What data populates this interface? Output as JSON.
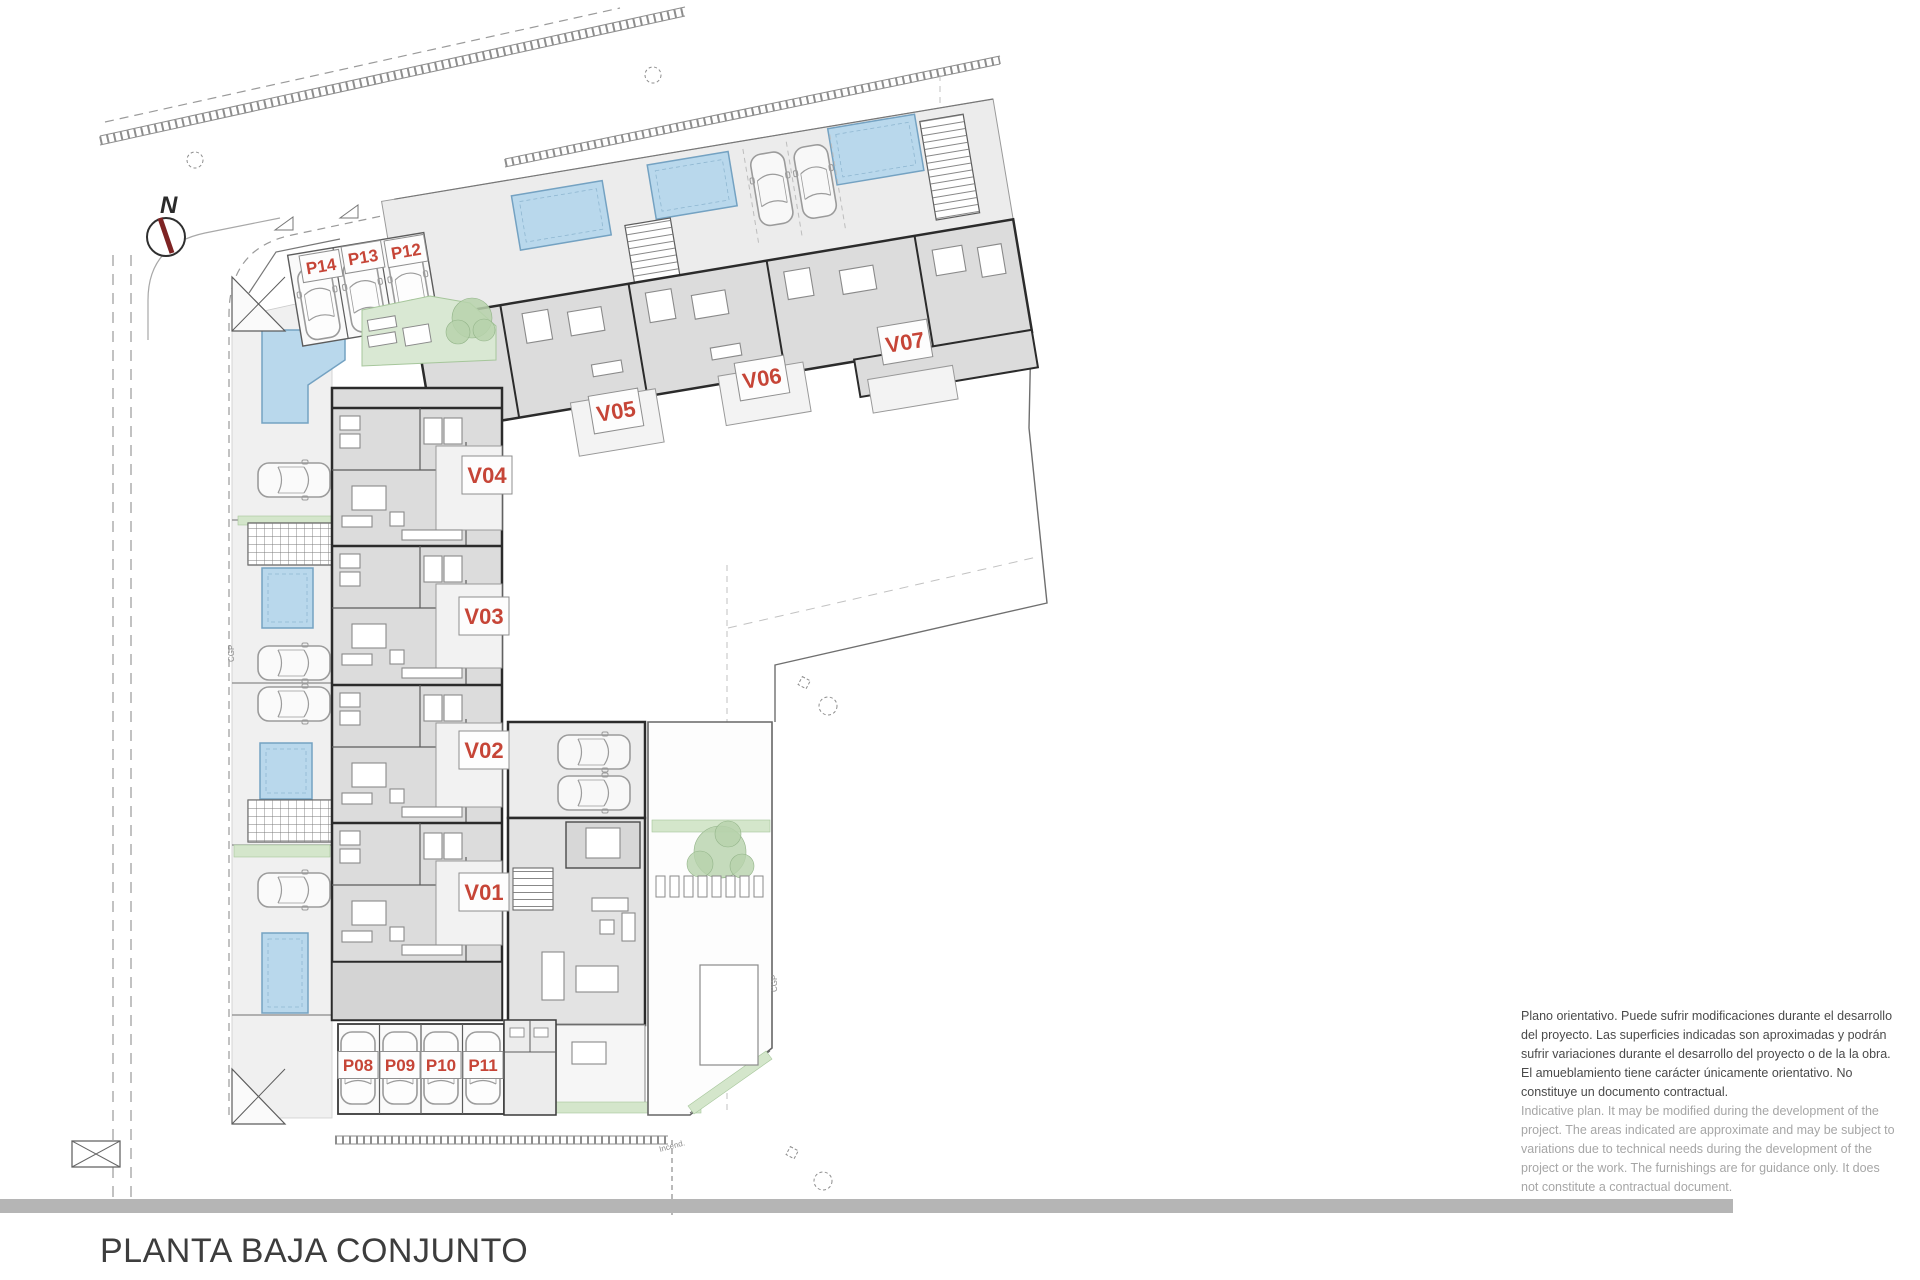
{
  "title": "PLANTA BAJA CONJUNTO",
  "compass_label": "N",
  "unit_labels": [
    {
      "id": "V01",
      "x": 484,
      "y": 892,
      "rot": 0
    },
    {
      "id": "V02",
      "x": 484,
      "y": 750,
      "rot": 0
    },
    {
      "id": "V03",
      "x": 484,
      "y": 616,
      "rot": 0
    },
    {
      "id": "V04",
      "x": 487,
      "y": 475,
      "rot": 0
    },
    {
      "id": "V05",
      "x": 616,
      "y": 411,
      "rot": -9.5
    },
    {
      "id": "V06",
      "x": 762,
      "y": 378,
      "rot": -9.5
    },
    {
      "id": "V07",
      "x": 905,
      "y": 342,
      "rot": -9.5
    }
  ],
  "parking_labels": [
    {
      "id": "P08",
      "x": 358,
      "y": 1065,
      "rot": 0
    },
    {
      "id": "P09",
      "x": 400,
      "y": 1065,
      "rot": 0
    },
    {
      "id": "P10",
      "x": 441,
      "y": 1065,
      "rot": 0
    },
    {
      "id": "P11",
      "x": 483,
      "y": 1065,
      "rot": 0
    },
    {
      "id": "P12",
      "x": 406,
      "y": 251,
      "rot": -9.5
    },
    {
      "id": "P13",
      "x": 363,
      "y": 257,
      "rot": -9.5
    },
    {
      "id": "P14",
      "x": 321,
      "y": 266,
      "rot": -9.5
    }
  ],
  "utility_labels": [
    {
      "text": "CGP",
      "x": 234,
      "y": 662,
      "rot": -90
    },
    {
      "text": "CGP",
      "x": 777,
      "y": 992,
      "rot": -90
    },
    {
      "text": "Incend.",
      "x": 660,
      "y": 1152,
      "rot": -15
    }
  ],
  "disclaimer": {
    "es_lines": [
      "Plano orientativo. Puede sufrir modificaciones durante el desarrollo",
      "del proyecto. Las superficies indicadas son aproximadas y podrán",
      "sufrir variaciones durante el desarrollo del proyecto o de la la obra.",
      "El amueblamiento tiene carácter únicamente orientativo. No",
      "constituye un documento contractual."
    ],
    "en_lines": [
      "Indicative plan. It may be modified during the development of the",
      "project. The areas indicated are approximate and may be subject to",
      "variations due to technical needs during the development of the",
      "project or the work. The furnishings are for guidance only. It does",
      "not constitute a contractual document."
    ]
  },
  "colors": {
    "label_red": "#c64537",
    "pool_fill": "#b9d8ec",
    "pool_edge": "#74a2c2",
    "green_fill": "#d4e6cb",
    "green_edge": "#a6c69b",
    "bar_gray": "#b5b5b5",
    "wall_ink": "#2b2b2b",
    "needle_red": "#7e2424",
    "disclaimer_dark": "#4a4a4a",
    "disclaimer_light": "#a6a6a6"
  }
}
